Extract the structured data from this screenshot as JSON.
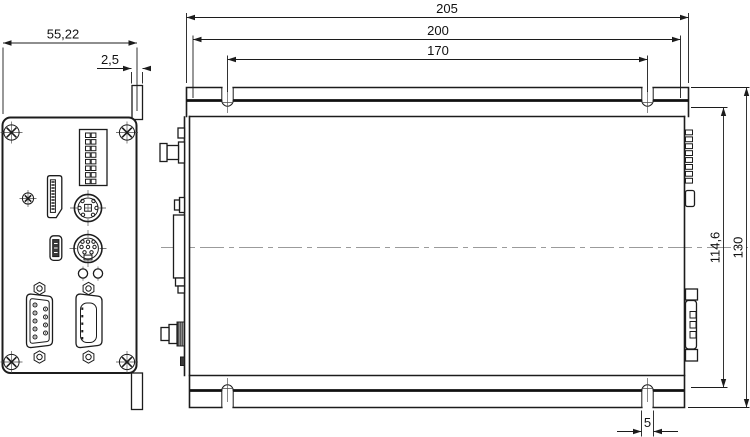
{
  "drawing": {
    "background": "#ffffff",
    "line_color": "#1c1c1c",
    "centerline_color": "#9b9b9b",
    "views": {
      "front": {
        "title": "front-panel-end-view",
        "dimensions": {
          "panel_width": "55,22",
          "tab_width": "2,5"
        },
        "features": [
          "phillips-screw",
          "phillips-screw",
          "phillips-screw",
          "phillips-screw",
          "dip-switch-8-position",
          "torx-screw",
          "displayport-connector",
          "mini-din-6-socket",
          "mini-usb-socket",
          "mini-din-8-socket",
          "led",
          "led",
          "dsub-9-male",
          "dsub-female"
        ]
      },
      "side": {
        "title": "side-view-with-mounting-flanges",
        "dimensions": {
          "overall_length": "205",
          "flange_length": "200",
          "slot_spacing": "170",
          "body_height": "114,6",
          "overall_height": "130",
          "slot_width": "5"
        }
      }
    }
  }
}
